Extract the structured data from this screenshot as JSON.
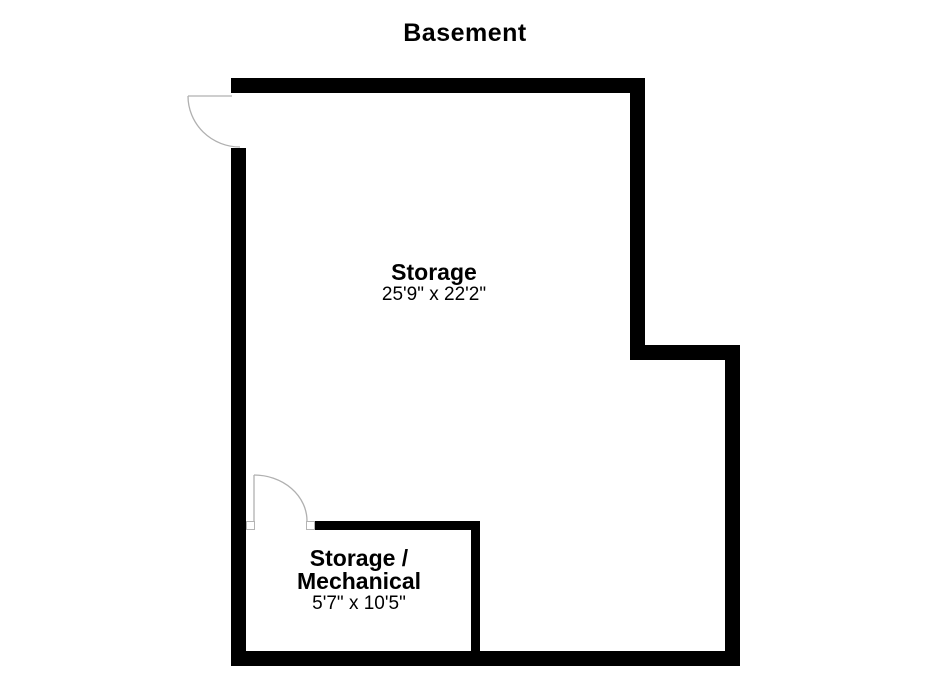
{
  "page": {
    "title": "Basement"
  },
  "colors": {
    "background": "#ffffff",
    "wall": "#000000",
    "text": "#000000",
    "door_line": "#b0b0b0"
  },
  "symbols": {
    "entry_door": "quarter-arc-door-swing",
    "inner_door": "quarter-arc-door-swing"
  },
  "rooms": [
    {
      "name": "Storage",
      "dimensions": "25'9\" x 22'2\""
    },
    {
      "name_line1": "Storage /",
      "name_line2": "Mechanical",
      "dimensions": "5'7\" x 10'5\""
    }
  ]
}
